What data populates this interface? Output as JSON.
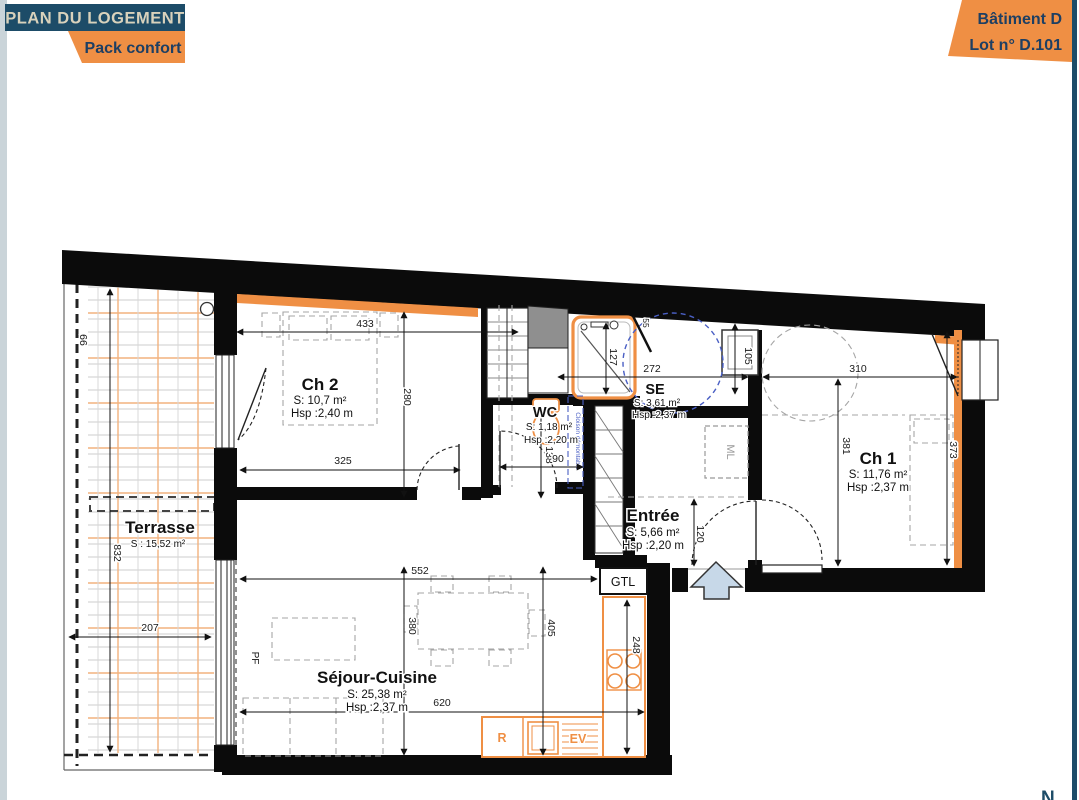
{
  "header": {
    "title": "PLAN DU LOGEMENT",
    "pack": "Pack confort",
    "batiment": "Bâtiment D",
    "lot": "Lot n° D.101"
  },
  "colors": {
    "header_blue": "#1d4c68",
    "header_text": "#d9d2bc",
    "orange": "#ef8f44",
    "navy": "#1d3f63",
    "wall_black": "#0b0b0b",
    "blue_dashed": "#4a5fc4",
    "arrow_fill": "#c7d8e8",
    "terrace_orange": "#f2b27e",
    "terrace_gray": "#cccccc"
  },
  "rooms": {
    "ch2": {
      "name": "Ch 2",
      "area": "S: 10,7 m²",
      "height": "Hsp :2,40 m"
    },
    "wc": {
      "name": "WC",
      "area": "S: 1,18 m²",
      "height": "Hsp :2,20 m"
    },
    "se": {
      "name": "SE",
      "area": "S: 3,61 m²",
      "height": "Hsp :2,37 m"
    },
    "entree": {
      "name": "Entrée",
      "area": "S: 5,66 m²",
      "height": "Hsp :2,20 m"
    },
    "ch1": {
      "name": "Ch 1",
      "area": "S: 11,76 m²",
      "height": "Hsp :2,37 m"
    },
    "terrasse": {
      "name": "Terrasse",
      "area": "S : 15,52 m²"
    },
    "sejour": {
      "name": "Séjour-Cuisine",
      "area": "S: 25,38 m²",
      "height": "Hsp :2,37 m"
    }
  },
  "dims": {
    "ch2_width": "433",
    "ch2_height": "280",
    "ch2_width2": "325",
    "shower_height": "127",
    "se_width": "272",
    "se_door": "55",
    "basin": "105",
    "wc_height": "138",
    "wc_width": "90",
    "entree_height": "120",
    "ch1_width": "310",
    "ch1_height": "381",
    "ch1_window": "373",
    "terrace_offset": "66",
    "terrace_height": "832",
    "terrace_width": "207",
    "sejour_width": "552",
    "sejour_height": "380",
    "sejour_height2": "405",
    "sejour_width2": "620",
    "kitchen_height": "248"
  },
  "fixtures": {
    "gtl": "GTL",
    "ml": "ML",
    "fridge": "R",
    "sink": "EV",
    "window_door": "PF",
    "partition_note": "Cloison démontable"
  },
  "compass_n": "N"
}
